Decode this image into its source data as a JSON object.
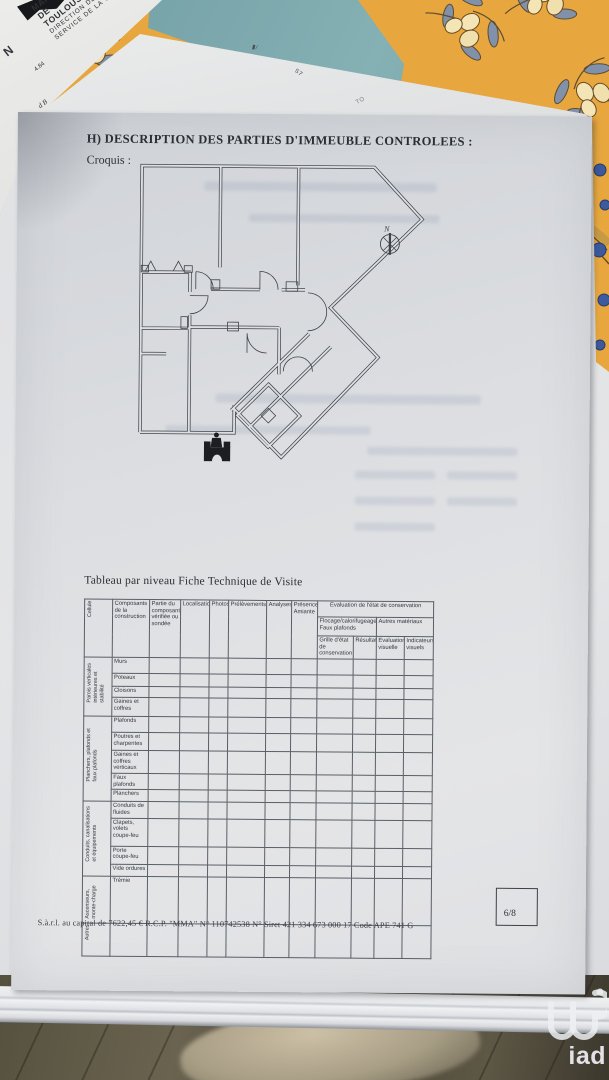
{
  "palette": {
    "tablecloth_yellow": "#e7a73e",
    "leaf_blue": "#8191a9",
    "olive_cream": "#f3e5b6",
    "teal_paper": "#74a0a6",
    "page_gray": "#dcdee1",
    "plan_line": "#3f434a",
    "floor_dark": "#4a4537",
    "watermark_white": "#eceef2"
  },
  "background": {
    "letterhead": {
      "lines": [
        "MAIRIE",
        "DE",
        "TOULOUSE"
      ],
      "direction": "DIRECTION DES TRAVAUX",
      "service": "SERVICE DE LA VOIE PUBLIQUE",
      "n_mark": "N",
      "num_fragment": "4.84",
      "corner_fragment": "d B"
    },
    "scraps": {
      "mark1": "S7",
      "mark2": "TO"
    }
  },
  "document": {
    "heading": "H) DESCRIPTION DES PARTIES D'IMMEUBLE CONTROLEES :",
    "croquis_label": "Croquis :",
    "compass_label": "N",
    "table_title": "Tableau par niveau  Fiche Technique de Visite",
    "page_number": "6/8",
    "footer": "S.à.r.l. au capital de 7622,45 €  R.C.P. \"MMA\"  N° 110742538  N° Siret 421 334 673 000 17  Code APE  741 G",
    "table": {
      "header": {
        "cellule": "Cellule",
        "composants": "Composants de la construction",
        "partie": "Partie du composant vérifiée ou sondée",
        "localisation": "Localisation",
        "photos": "Photos",
        "prelevements": "Prélèvements",
        "analyses": "Analyses",
        "presence_amiante": "Présence Amiante",
        "evaluation": "Evaluation de l'état de conservation",
        "flocage": "Flocage/calorifugeage Faux plafonds",
        "autres_materiaux": "Autres matériaux",
        "grille": "Grille d'état de conservation",
        "resultat": "Résultat",
        "eval_visuelle": "Evaluation visuelle",
        "indicateurs": "Indicateurs visuels"
      },
      "groups": [
        {
          "label": "Parois verticales intérieures et stabilité",
          "rows": [
            {
              "label": "Murs",
              "h": 13
            },
            {
              "label": "Poteaux",
              "h": 10
            },
            {
              "label": "Cloisons",
              "h": 8
            },
            {
              "label": "Gaines et coffres",
              "h": 16
            }
          ]
        },
        {
          "label": "Planchers, plafonds et faux plafonds",
          "rows": [
            {
              "label": "Plafonds",
              "h": 13
            },
            {
              "label": "Poutres et charpentes",
              "h": 15
            },
            {
              "label": "Gaines et coffres verticaux",
              "h": 19
            },
            {
              "label": "Faux plafonds",
              "h": 11
            },
            {
              "label": "Planchers",
              "h": 9
            }
          ]
        },
        {
          "label": "Conduits, canalisations et équipements",
          "rows": [
            {
              "label": "Conduits de fluides",
              "h": 13
            },
            {
              "label": "Clapets, volets coupe-feu",
              "h": 25
            },
            {
              "label": "Porte coupe-feu",
              "h": 15
            },
            {
              "label": "Vide ordures",
              "h": 9
            }
          ]
        },
        {
          "label": "Ascenseurs, monte-charge",
          "rows": [
            {
              "label": "Trémie",
              "h": 44
            }
          ]
        },
        {
          "label": "Autres",
          "rows": [
            {
              "label": "",
              "h": 30
            }
          ]
        }
      ]
    }
  },
  "watermark": {
    "brand": "iad"
  }
}
